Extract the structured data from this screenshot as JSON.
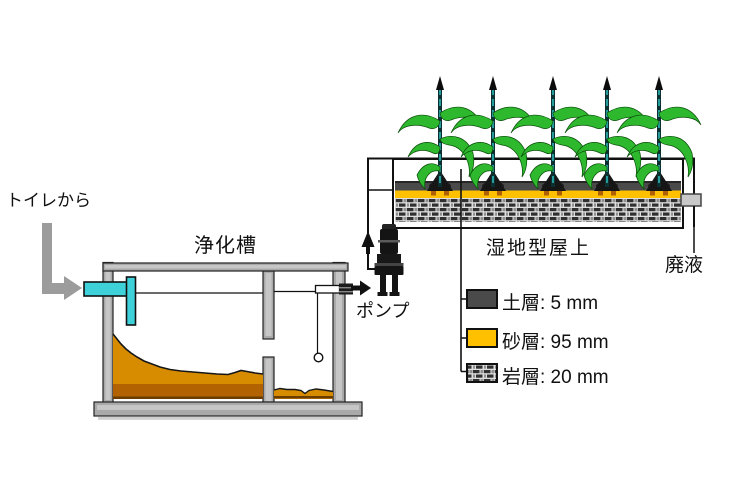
{
  "labels": {
    "source": "トイレから",
    "septic_tank": "浄化槽",
    "pump": "ポンプ",
    "wetland_roof": "湿地型屋上",
    "effluent": "廃液"
  },
  "legend": {
    "items": [
      {
        "swatch": "soil-layer",
        "text": "土層: 5 mm"
      },
      {
        "swatch": "sand-layer",
        "text": "砂層: 95 mm"
      },
      {
        "swatch": "rock-layer",
        "text": "岩層: 20 mm"
      }
    ]
  },
  "plants": {
    "count": 5,
    "x_positions": [
      440,
      493,
      553,
      607,
      659
    ]
  },
  "colors": {
    "pipe_cyan": "#3fd1d9",
    "sludge_orange": "#d78c00",
    "sludge_dark": "#b26200",
    "sand_yellow": "#ffc000",
    "soil_gray": "#4a4a4a",
    "tank_gray": "#a9a9a9",
    "arrow_gray": "#9c9c9c",
    "leaf_green": "#2db82d",
    "stem_teal": "#2aa7a7"
  }
}
